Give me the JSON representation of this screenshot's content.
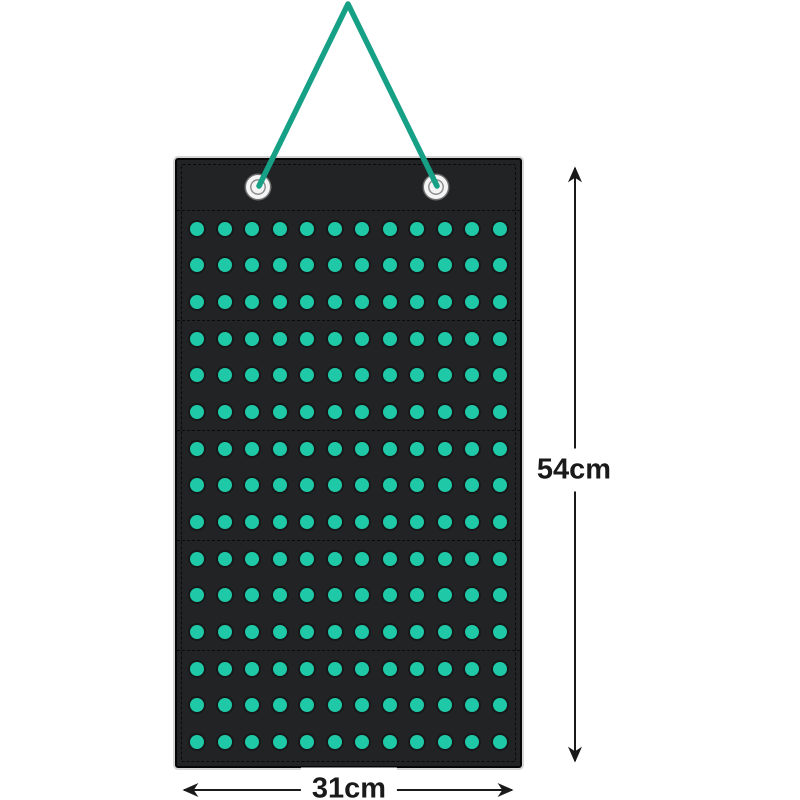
{
  "scene": {
    "type": "product-dimension-diagram",
    "description": "Black hanging felt organizer panel with teal dots, hung on a teal cord through two metal grommets, annotated with height and width dimensions"
  },
  "product": {
    "grommets": 2,
    "sections": 5,
    "rows_per_section": 3,
    "dots_per_row": 12
  },
  "dimensions": {
    "height": "54cm",
    "width": "31cm"
  },
  "colors": {
    "background": "#ffffff",
    "panel": "#212325",
    "panel-border": "#060606",
    "stitch": "#0a0a0a",
    "dot": "#1fc8a6",
    "cord": "#16a085",
    "grommet": "#f4f4f4",
    "dimension": "#1a1a1a"
  }
}
